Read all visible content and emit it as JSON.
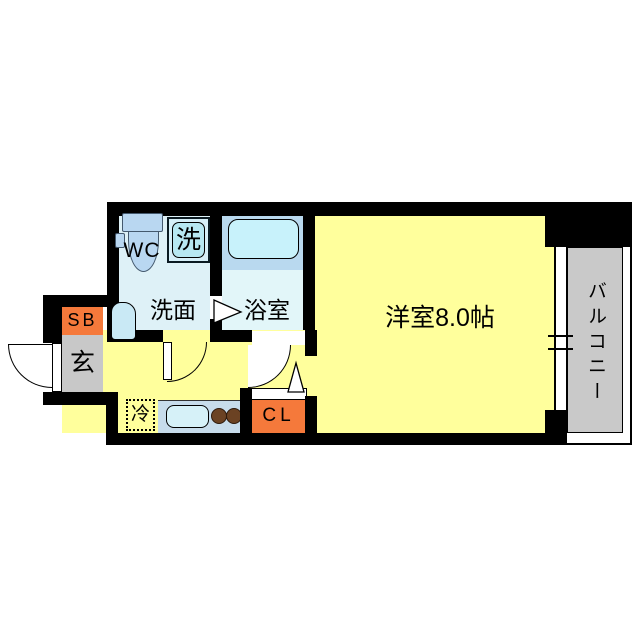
{
  "meta": {
    "type": "japanese-apartment-floor-plan",
    "main_room_size_tatami": "8.0"
  },
  "rooms": {
    "main_room": "洋室8.0帖",
    "balcony": "バルコニー",
    "washroom": "洗面",
    "bathroom": "浴室",
    "toilet": "WC",
    "washing_machine": "洗",
    "entrance": "玄",
    "shoe_box": "SB",
    "closet": "CL",
    "refrigerator": "冷"
  },
  "colors": {
    "wall_black": "#000000",
    "room_yellow": "#ffff9c",
    "wet_area_blue": "#def1f7",
    "bath_floor_blue": "#e2f6f9",
    "bath_platform_blue": "#b9d9ef",
    "bathtub_blue": "#c8f2fb",
    "fixture_blue": "#b9d7f1",
    "washer_blue": "#b7e8f2",
    "balcony_gray": "#c9c9c9",
    "entrance_gray": "#c8c8c8",
    "storage_orange": "#f5793b",
    "counter_blue": "#c7dceb",
    "sink_blue": "#d6f1f8",
    "burner_brown": "#6b4223"
  }
}
